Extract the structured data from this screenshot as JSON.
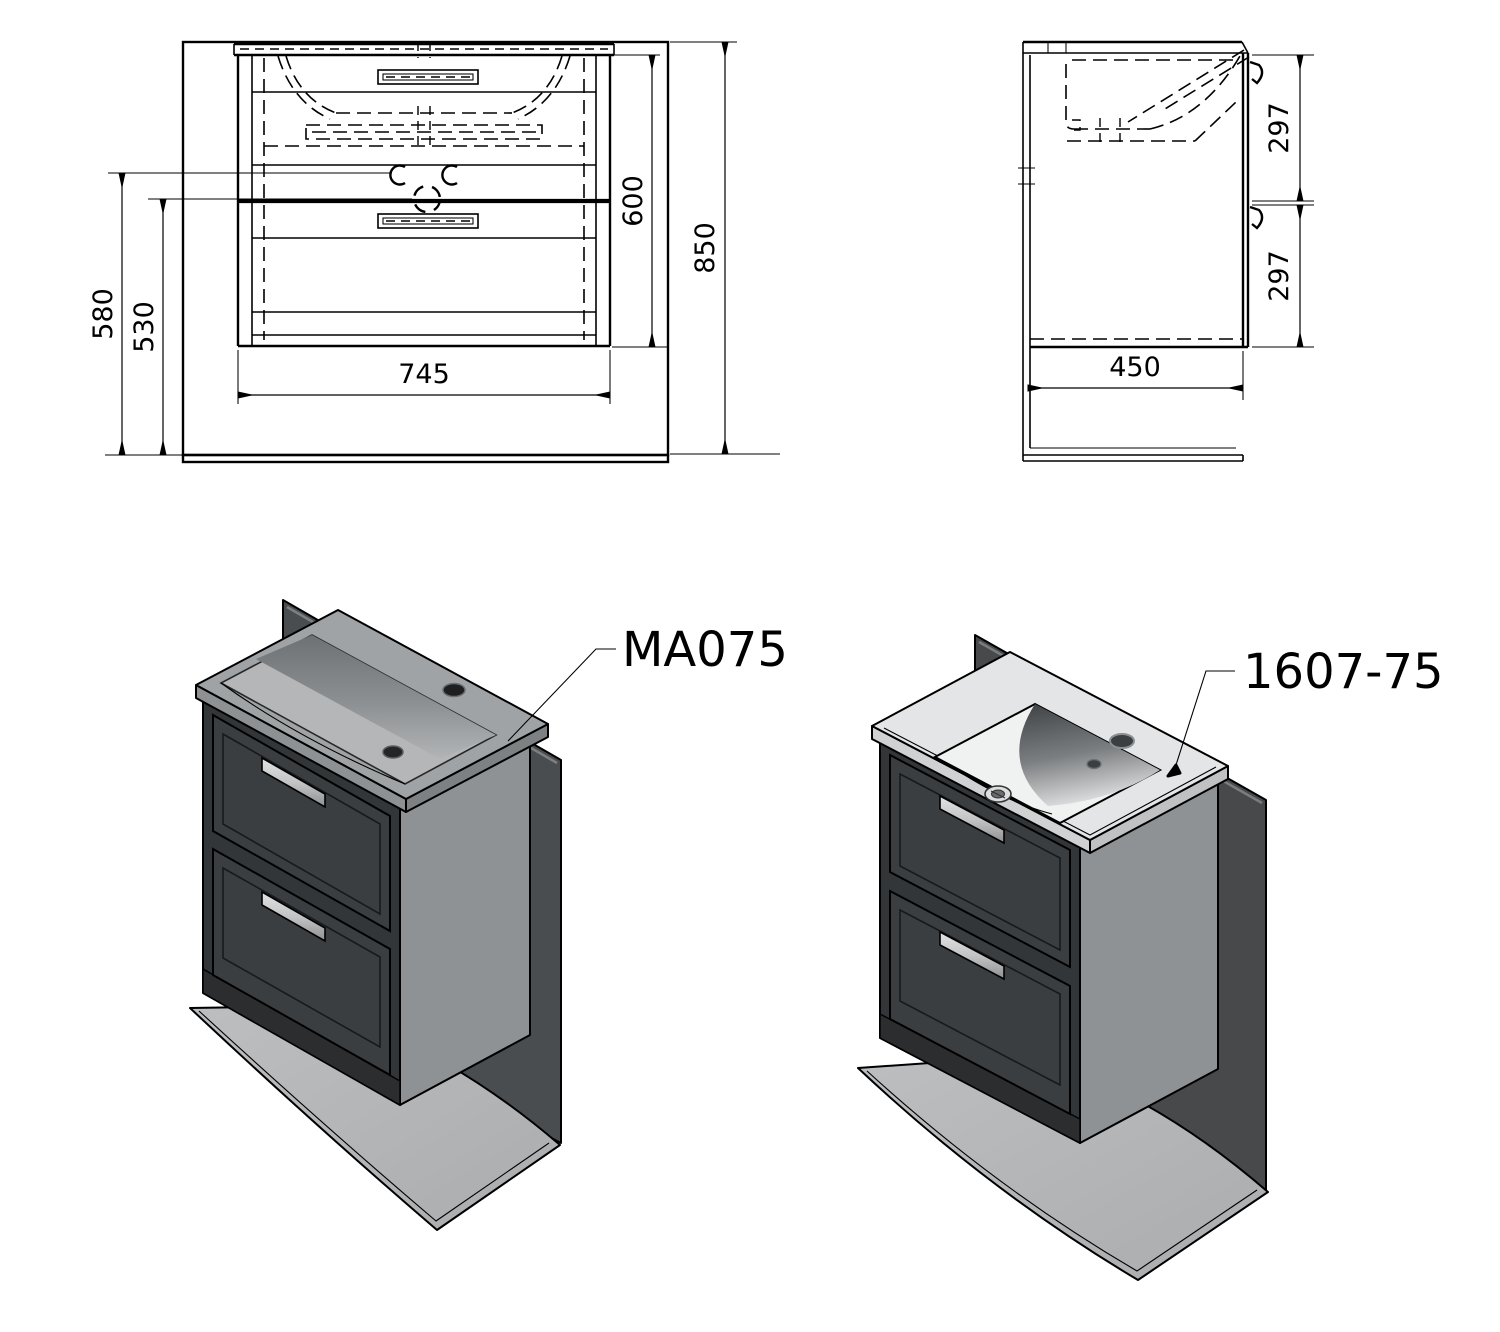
{
  "drawing": {
    "title_visible_text": "",
    "front_view": {
      "dim_width": "745",
      "dim_cabinet_height": "600",
      "dim_total_height": "850",
      "dim_left_outer": "580",
      "dim_left_inner": "530"
    },
    "side_view": {
      "dim_depth": "450",
      "dim_upper": "297",
      "dim_lower": "297"
    },
    "products": {
      "left_code": "MA075",
      "right_code": "1607-75"
    },
    "colors": {
      "line": "#000000",
      "background": "#ffffff",
      "cabinet_front": "#333639",
      "cabinet_drawer": "#3b3e41",
      "cabinet_side": "#8f9294",
      "cabinet_plinth": "#2b2d2f",
      "wall_panel": "#4a4d4f",
      "floor_panel": "#b3b5b7",
      "basin_gray": "#a0a3a5",
      "basin_slope_dark": "#6e7173",
      "ceramic_deck": "#e4e5e6",
      "bowl_dark": "#45484a",
      "handle_metal": "#cbcdce"
    }
  }
}
